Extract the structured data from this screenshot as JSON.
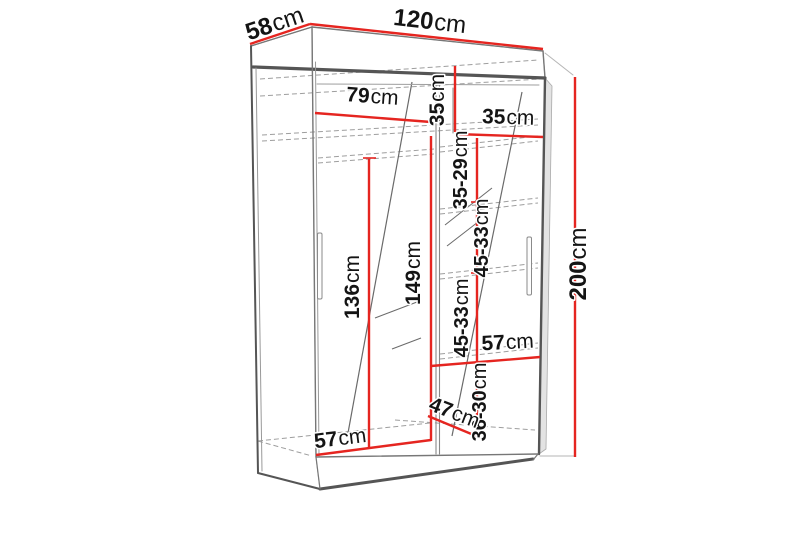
{
  "diagram": {
    "kind": "wardrobe-dimension-drawing",
    "unit": "cm"
  },
  "colors": {
    "dimension": "#e52520",
    "outline": "#555555",
    "outline_light": "#8a8a8a",
    "hidden": "#9e9e9e",
    "text": "#141414",
    "background": "#ffffff"
  },
  "dimensions": {
    "top_depth": {
      "value": "58",
      "unit": "cm"
    },
    "top_width": {
      "value": "120",
      "unit": "cm"
    },
    "left_section_width": {
      "value": "79",
      "unit": "cm"
    },
    "top_shelf_height": {
      "value": "35",
      "unit": "cm"
    },
    "right_shelf_width": {
      "value": "35",
      "unit": "cm"
    },
    "right_gap_1": {
      "value": "35-29",
      "unit": "cm"
    },
    "right_gap_2": {
      "value": "45-33",
      "unit": "cm"
    },
    "left_hanging_height": {
      "value": "136",
      "unit": "cm"
    },
    "center_hanging_height": {
      "value": "149",
      "unit": "cm"
    },
    "right_gap_3": {
      "value": "45-33",
      "unit": "cm"
    },
    "right_lower_width": {
      "value": "57",
      "unit": "cm"
    },
    "right_gap_4": {
      "value": "36-30",
      "unit": "cm"
    },
    "bottom_depth": {
      "value": "47",
      "unit": "cm"
    },
    "left_lower_width": {
      "value": "57",
      "unit": "cm"
    },
    "total_height": {
      "value": "200",
      "unit": "cm"
    }
  }
}
